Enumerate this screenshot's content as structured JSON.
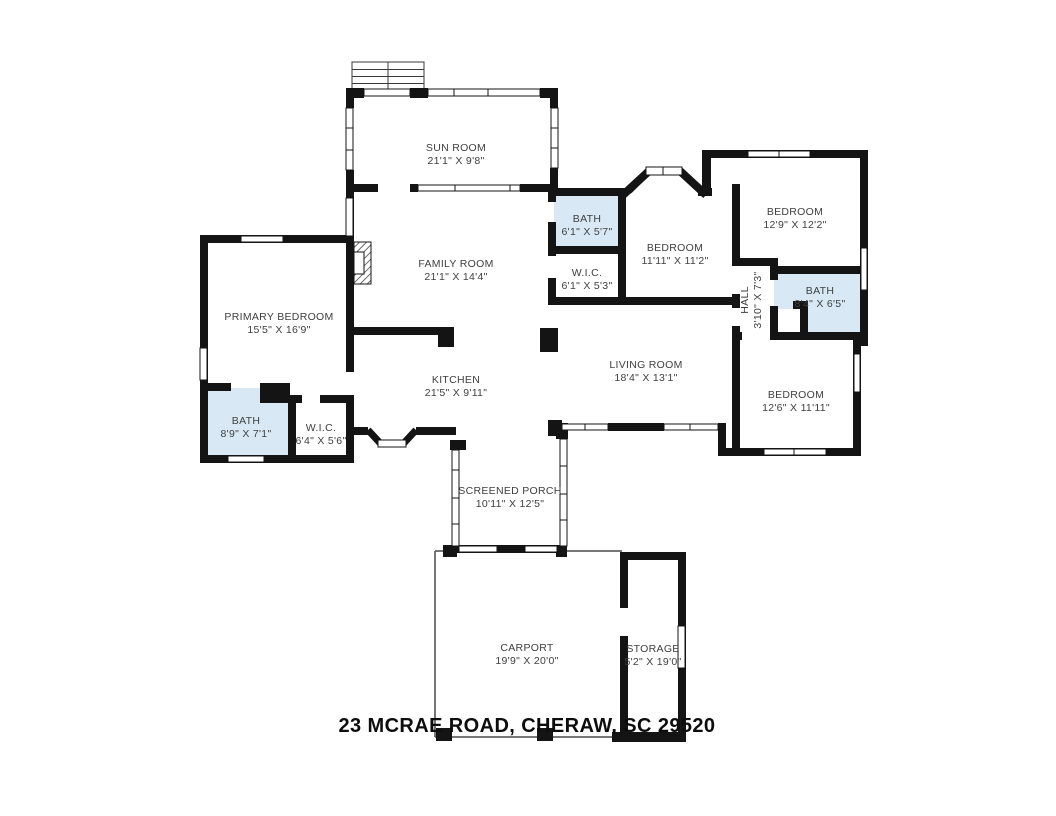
{
  "address": "23 MCRAE ROAD, CHERAW, SC 29520",
  "colors": {
    "wall": "#141414",
    "bath_fill": "#d8e9f5",
    "label": "#404040"
  },
  "rooms": {
    "sun_room": {
      "name": "SUN ROOM",
      "dims": "21'1\" X 9'8\""
    },
    "family_room": {
      "name": "FAMILY ROOM",
      "dims": "21'1\" X 14'4\""
    },
    "bath_top": {
      "name": "BATH",
      "dims": "6'1\" X 5'7\""
    },
    "wic_top": {
      "name": "W.I.C.",
      "dims": "6'1\" X 5'3\""
    },
    "bedroom_middle": {
      "name": "BEDROOM",
      "dims": "11'11\" X 11'2\""
    },
    "bedroom_top_right": {
      "name": "BEDROOM",
      "dims": "12'9\" X 12'2\""
    },
    "hall": {
      "name": "HALL",
      "dims": "3'10\" X 7'3\""
    },
    "bath_right": {
      "name": "BATH",
      "dims": "8'4\" X 6'5\""
    },
    "bedroom_bottom_right": {
      "name": "BEDROOM",
      "dims": "12'6\" X 11'11\""
    },
    "living_room": {
      "name": "LIVING ROOM",
      "dims": "18'4\" X 13'1\""
    },
    "kitchen": {
      "name": "KITCHEN",
      "dims": "21'5\" X 9'11\""
    },
    "primary_bedroom": {
      "name": "PRIMARY BEDROOM",
      "dims": "15'5\" X 16'9\""
    },
    "bath_left": {
      "name": "BATH",
      "dims": "8'9\" X 7'1\""
    },
    "wic_left": {
      "name": "W.I.C.",
      "dims": "6'4\" X 5'6\""
    },
    "screened_porch": {
      "name": "SCREENED PORCH",
      "dims": "10'11\" X 12'5\""
    },
    "carport": {
      "name": "CARPORT",
      "dims": "19'9\" X 20'0\""
    },
    "storage": {
      "name": "STORAGE",
      "dims": "5'2\" X 19'0\""
    }
  }
}
